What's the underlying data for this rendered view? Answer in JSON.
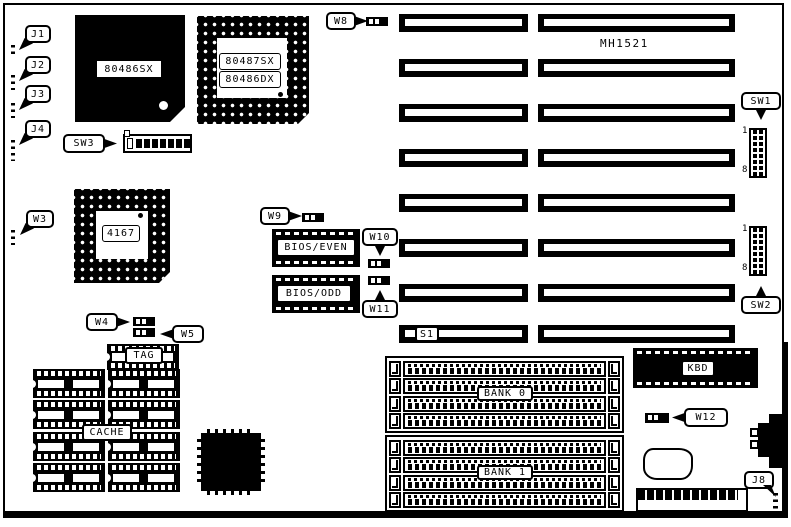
{
  "diagram": {
    "board_model": "MH1521",
    "cpu_label": "80486SX",
    "fpu_label_line1": "80487SX",
    "fpu_label_line2": "80486DX",
    "chipset_label": "4167",
    "bios_even_label": "BIOS/EVEN",
    "bios_odd_label": "BIOS/ODD",
    "tag_label": "TAG",
    "cache_label": "CACHE",
    "bank0_label": "BANK 0",
    "bank1_label": "BANK 1",
    "kbd_label": "KBD",
    "slot_s1_label": "S1",
    "switch_pin_first": "1",
    "switch_pin_last": "8",
    "callouts": {
      "j1": "J1",
      "j2": "J2",
      "j3": "J3",
      "j4": "J4",
      "j8": "J8",
      "w3": "W3",
      "w4": "W4",
      "w5": "W5",
      "w8": "W8",
      "w9": "W9",
      "w10": "W10",
      "w11": "W11",
      "w12": "W12",
      "sw1": "SW1",
      "sw2": "SW2",
      "sw3": "SW3"
    }
  }
}
